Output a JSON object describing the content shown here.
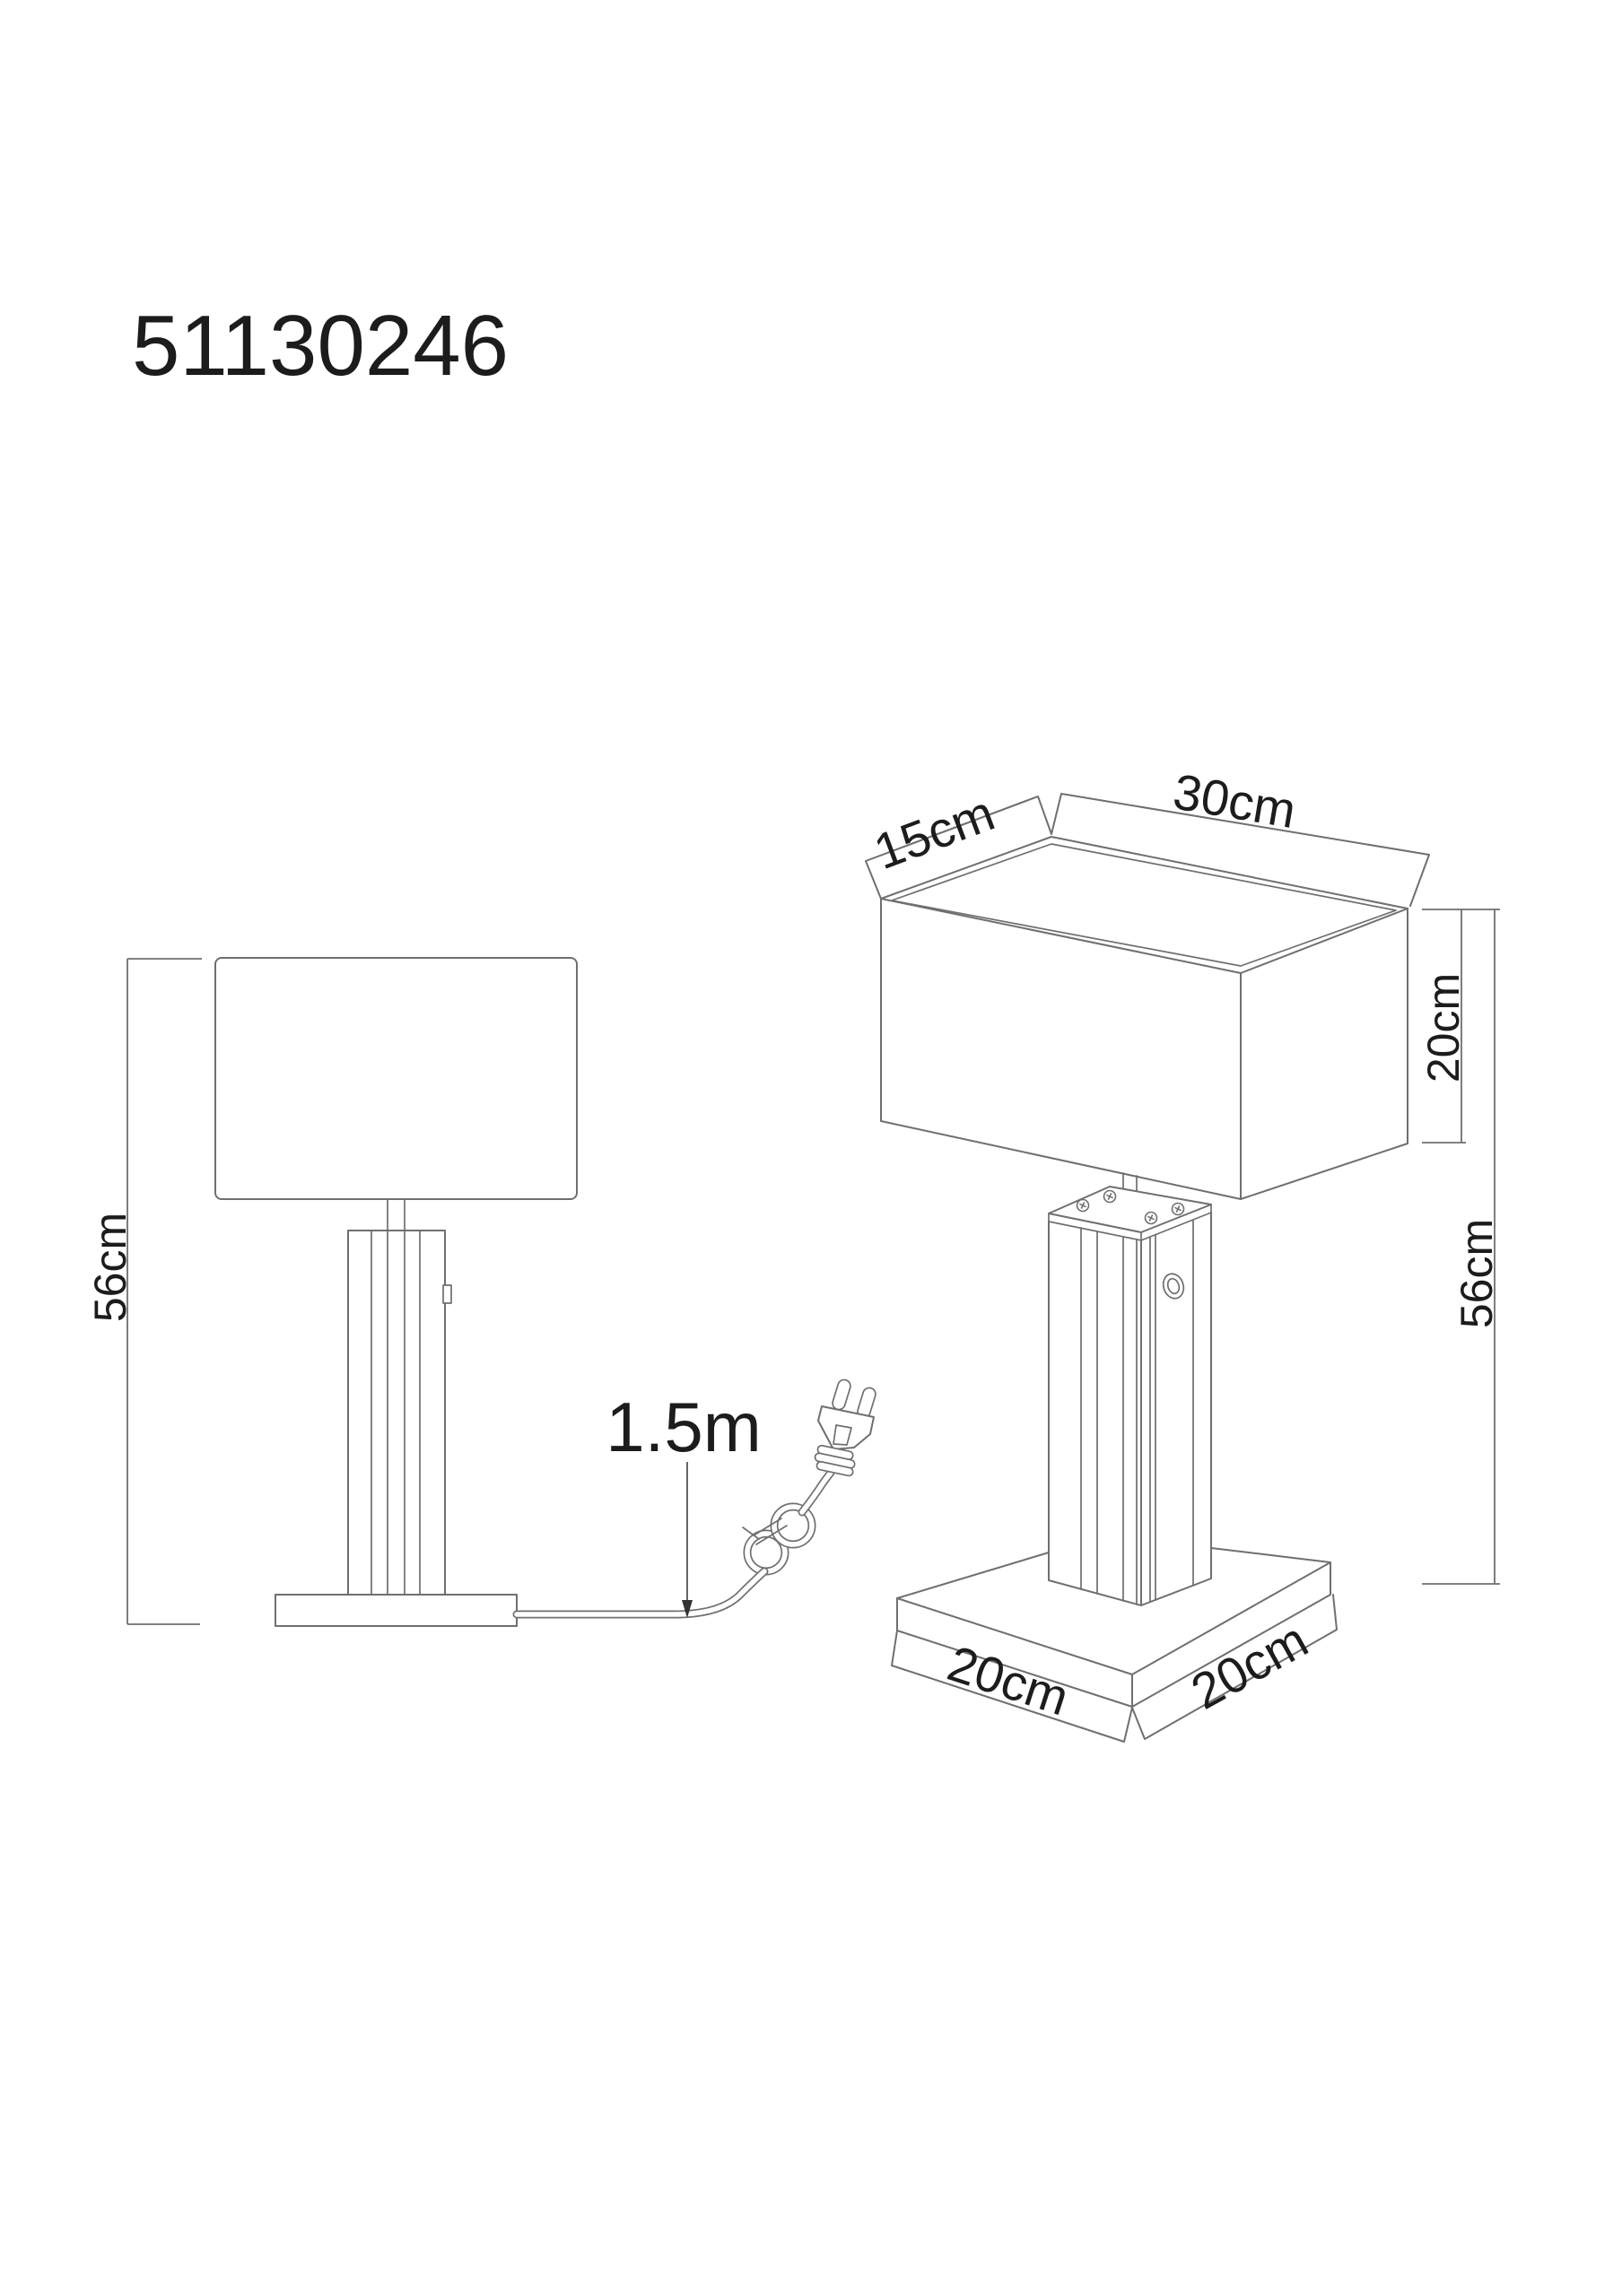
{
  "drawing": {
    "article_number": "51130246",
    "front_view": {
      "height": "56cm",
      "cord_length": "1.5m"
    },
    "perspective_view": {
      "shade_depth": "15cm",
      "shade_width": "30cm",
      "shade_height": "20cm",
      "total_height": "56cm",
      "base_side_left": "20cm",
      "base_side_right": "20cm"
    },
    "colors": {
      "line": "#6f6f6f",
      "text": "#1c1c1c",
      "arrow": "#333333",
      "background": "#ffffff"
    }
  }
}
